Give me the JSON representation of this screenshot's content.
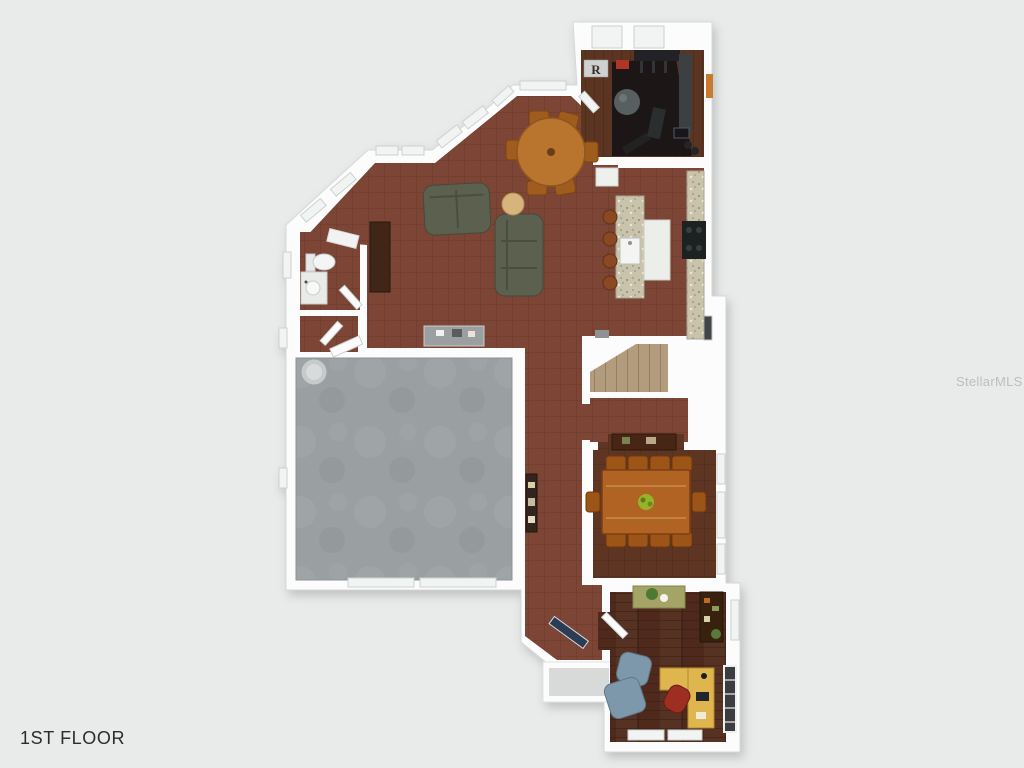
{
  "labels": {
    "floor": "1ST FLOOR",
    "watermark": "StellarMLS",
    "gym_sign": "R"
  },
  "palette": {
    "bg": "#e9ebea",
    "wall": "#fcfcfc",
    "wallEdge": "#d5d8d7",
    "woodMain": "#7b4536",
    "woodDark": "#5d3423",
    "woodOffice": "#4f2c1b",
    "woodGym": "#5c3523",
    "garageFloor": "#9aa0a1",
    "granite": "#c9c3ac",
    "stairTread": "#b39c7e",
    "sofa": "#5b604f",
    "nookTable": "#b9752f",
    "chairWood": "#a05c1d",
    "diningTable": "#b06324",
    "buffet": "#462818",
    "desk": "#dfb54d",
    "armchair": "#7e98ab",
    "deskChair": "#9e2e22",
    "frontDoor": "#2c3e55",
    "porchStep": "#d8dada",
    "gymMat": "#161616",
    "exerciseBall": "#595e61",
    "waterHeater": "#c7cacb"
  },
  "rooms": [
    "gym",
    "breakfast-nook",
    "living-room",
    "kitchen",
    "powder-room",
    "closet",
    "garage",
    "hallway",
    "stairs",
    "dining-room",
    "foyer",
    "office",
    "porch"
  ]
}
